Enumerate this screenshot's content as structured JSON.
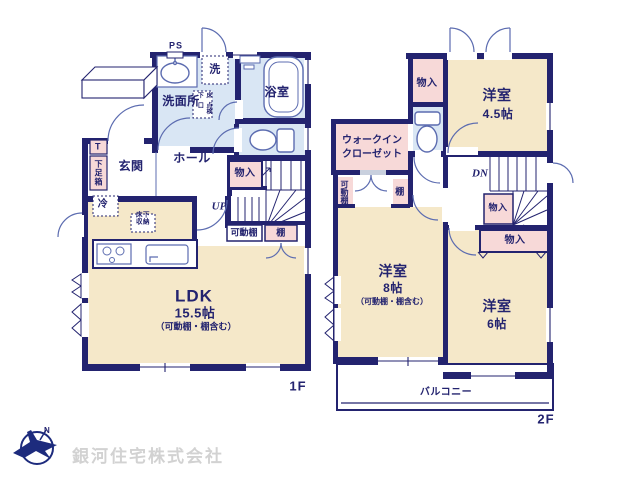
{
  "colors": {
    "wall": "#23236f",
    "fixture": "#5c6cb0",
    "room_cream": "#f5e8c9",
    "room_pink": "#f7d9d8",
    "room_blue": "#d9e6f4",
    "logo_navy": "#1d2b7d",
    "company_text_gray": "#d2d2d2"
  },
  "floor1": {
    "floor_label": "1F",
    "ps": "PS",
    "laundry": "洗",
    "washroom": "洗面所",
    "inspection_col_right": "床下",
    "inspection_col_left": "点検口",
    "bathroom": "浴室",
    "entrance": "玄関",
    "shoe_t": "T",
    "shoe_box": "下足箱",
    "hall": "ホール",
    "closet": "物入",
    "up": "UP",
    "movable_shelf": "可動棚",
    "shelf": "棚",
    "fridge": "冷",
    "underfloor_line1": "床下",
    "underfloor_line2": "収納",
    "ldk_name": "LDK",
    "ldk_size": "15.5帖",
    "ldk_note": "（可動棚・棚含む）"
  },
  "floor2": {
    "floor_label": "2F",
    "closet_top": "物入",
    "room45_name": "洋室",
    "room45_size": "4.5帖",
    "wic_line1": "ウォークイン",
    "wic_line2": "クローゼット",
    "movable_shelf": "可動棚",
    "shelf": "棚",
    "dn": "DN",
    "closet_stair": "物入",
    "closet_wide": "物入",
    "room8_name": "洋室",
    "room8_size": "8帖",
    "room8_note": "（可動棚・棚含む）",
    "room6_name": "洋室",
    "room6_size": "6帖",
    "balcony": "バルコニー"
  },
  "company": {
    "name": "銀河住宅株式会社",
    "compass_n": "N"
  }
}
